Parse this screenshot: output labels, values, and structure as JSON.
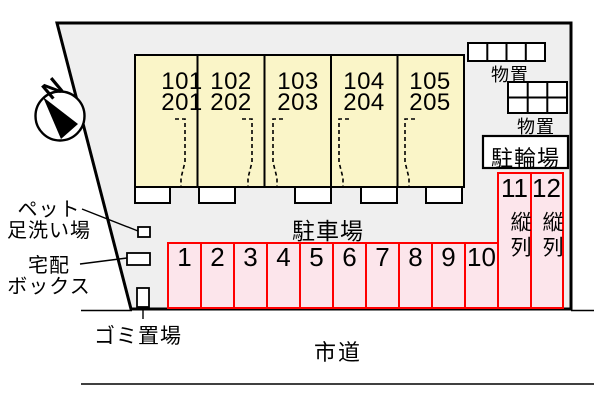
{
  "compass": {
    "label": "N"
  },
  "building": {
    "units": [
      {
        "upper": "101",
        "lower": "201"
      },
      {
        "upper": "102",
        "lower": "202"
      },
      {
        "upper": "103",
        "lower": "203"
      },
      {
        "upper": "104",
        "lower": "204"
      },
      {
        "upper": "105",
        "lower": "205"
      }
    ]
  },
  "storage": {
    "shed1_label": "物置",
    "shed2_label": "物置"
  },
  "bicycle_parking": {
    "label": "駐輪場"
  },
  "parking": {
    "label": "駐車場",
    "spaces": [
      "1",
      "2",
      "3",
      "4",
      "5",
      "6",
      "7",
      "8",
      "9",
      "10"
    ],
    "tandem": [
      {
        "number": "11",
        "label": "縦列"
      },
      {
        "number": "12",
        "label": "縦列"
      }
    ]
  },
  "facilities": {
    "pet_wash": {
      "line1": "ペット",
      "line2": "足洗い場"
    },
    "delivery_box": {
      "line1": "宅配",
      "line2": "ボックス"
    },
    "garbage": {
      "label": "ゴミ置場"
    }
  },
  "road": {
    "label": "市道"
  },
  "colors": {
    "site_fill": "#EFEFEF",
    "building_fill": "#FAF5C8",
    "parking_fill": "#FCE5EB",
    "parking_border": "#FF0000",
    "outline": "#000000"
  }
}
